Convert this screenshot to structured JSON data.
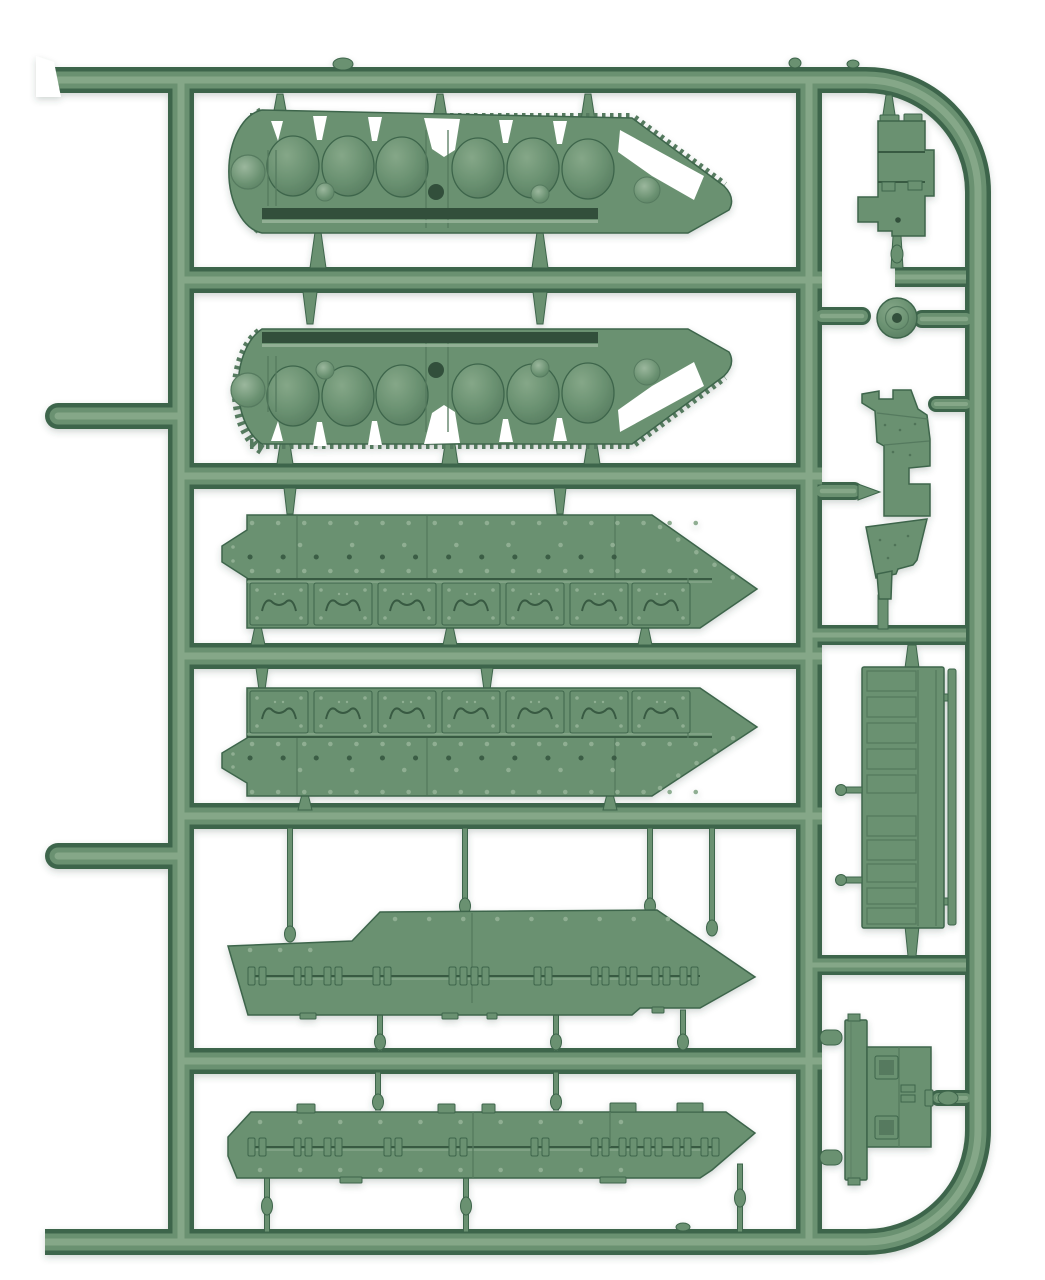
{
  "scene": {
    "subject": "photograph of an injection-moulded plastic model kit sprue with miniature tank hull and track parts",
    "background_color": "#ffffff",
    "visible_text": ""
  },
  "sprue": {
    "plastic_color_name": "sage green",
    "colors": {
      "background": "#ffffff",
      "plastic_base": "#6a9171",
      "plastic_dark": "#3e654b",
      "plastic_shadow": "#557a5e",
      "plastic_light": "#85a788",
      "plastic_highlight": "#9bb79d",
      "recess_dark": "#30503b",
      "rivet_light": "#8fae92",
      "shadow_tint": "#3a4a3e"
    },
    "parts": [
      {
        "id": "track-suspension-unit-top",
        "label": "tracked suspension unit with six road wheels (upper copy)"
      },
      {
        "id": "track-suspension-unit-bottom",
        "label": "tracked suspension unit with six road wheels (lower mirrored copy)"
      },
      {
        "id": "riveted-hull-side-a",
        "label": "riveted hull side plate with seven armour segments"
      },
      {
        "id": "riveted-hull-side-b",
        "label": "riveted hull side plate, mirrored"
      },
      {
        "id": "stepped-hull-deck",
        "label": "stepped hull deck plate with hinge clamps and pointed bow"
      },
      {
        "id": "hull-floor-plate",
        "label": "hull floor plate with hinge clamps and pointed bow"
      },
      {
        "id": "stowage-box",
        "label": "stowage box / fuel tank"
      },
      {
        "id": "road-wheel",
        "label": "single road wheel with hub hole"
      },
      {
        "id": "exhaust-bracket",
        "label": "exhaust bracket assembly"
      },
      {
        "id": "engine-grille-deck",
        "label": "engine deck with louvred mesh grilles and side rail"
      },
      {
        "id": "hatch-plate",
        "label": "hatch plate with two square hatches"
      }
    ],
    "counts": {
      "road_wheels_per_suspension_unit": 6,
      "armour_plate_segments_per_side": 7,
      "grille_bands_on_engine_deck": 10,
      "left_edge_cut_stubs": 2
    }
  }
}
